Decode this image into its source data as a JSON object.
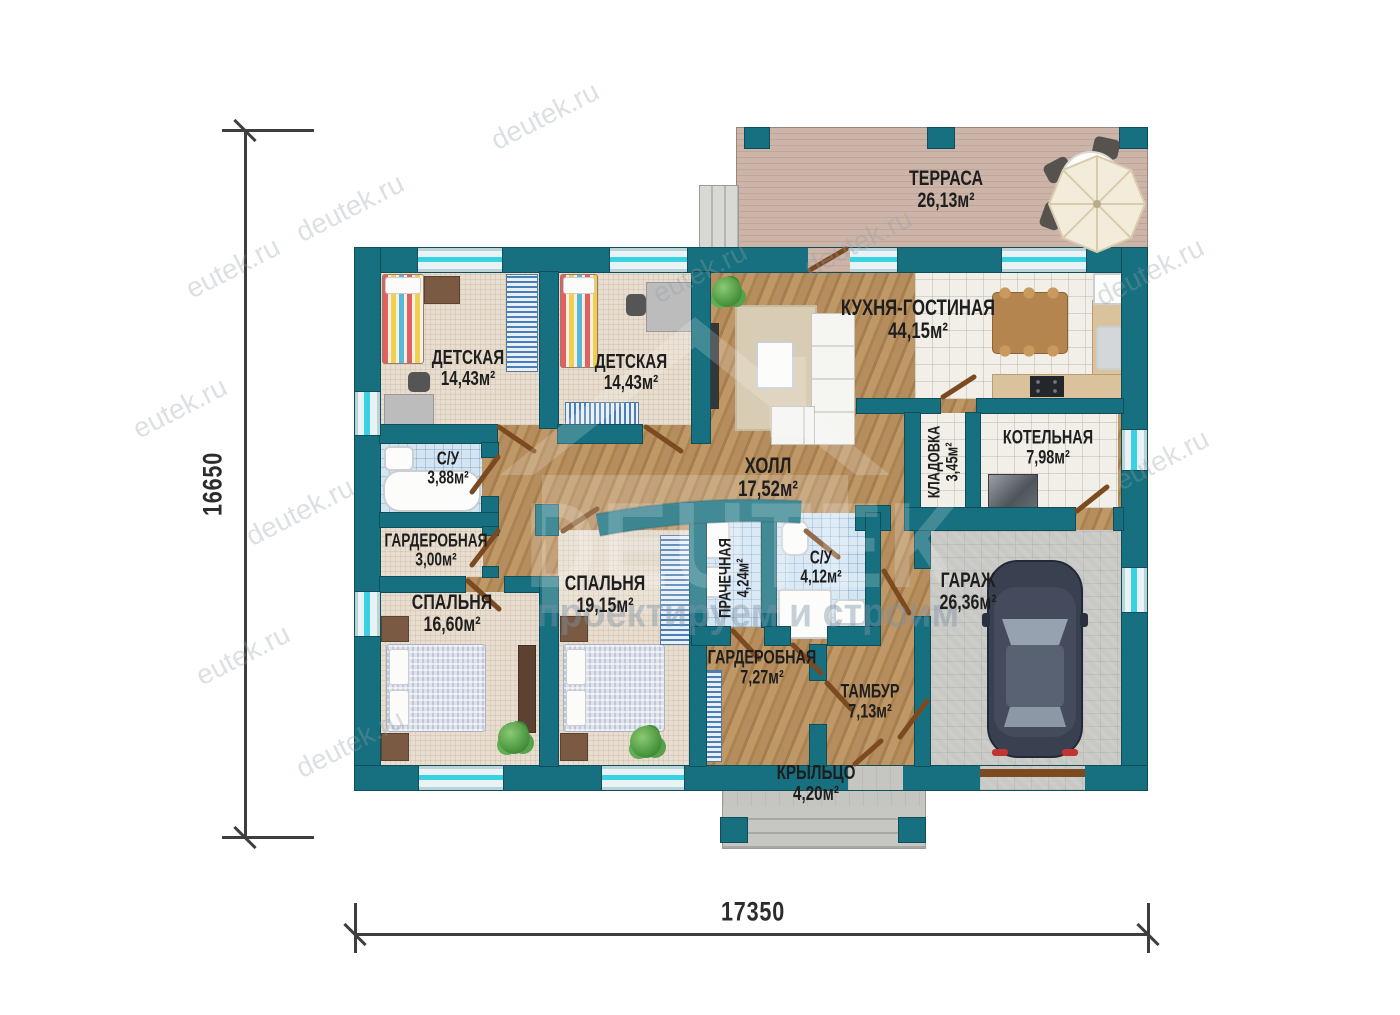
{
  "dimensions": {
    "horizontal": "17350",
    "vertical": "16650"
  },
  "rooms": {
    "terrace": {
      "name": "ТЕРРАСА",
      "area": "26,13м²"
    },
    "nursery1": {
      "name": "ДЕТСКАЯ",
      "area": "14,43м²"
    },
    "nursery2": {
      "name": "ДЕТСКАЯ",
      "area": "14,43м²"
    },
    "kitchen_living": {
      "name": "КУХНЯ-ГОСТИНАЯ",
      "area": "44,15м²"
    },
    "bathroom1": {
      "name": "С/У",
      "area": "3,88м²"
    },
    "hall": {
      "name": "ХОЛЛ",
      "area": "17,52м²"
    },
    "pantry": {
      "name": "КЛАДОВКА",
      "area": "3,45м²"
    },
    "boiler": {
      "name": "КОТЕЛЬНАЯ",
      "area": "7,98м²"
    },
    "wardrobe1": {
      "name": "ГАРДЕРОБНАЯ",
      "area": "3,00м²"
    },
    "bedroom1": {
      "name": "СПАЛЬНЯ",
      "area": "16,60м²"
    },
    "bedroom2": {
      "name": "СПАЛЬНЯ",
      "area": "19,15м²"
    },
    "laundry": {
      "name": "ПРАЧЕЧНАЯ",
      "area": "4,24м²"
    },
    "bathroom2": {
      "name": "С/У",
      "area": "4,12м²"
    },
    "wardrobe2": {
      "name": "ГАРДЕРОБНАЯ",
      "area": "7,27м²"
    },
    "vestibule": {
      "name": "ТАМБУР",
      "area": "7,13м²"
    },
    "garage": {
      "name": "ГАРАЖ",
      "area": "26,36м²"
    },
    "porch": {
      "name": "КРЫЛЬЦО",
      "area": "4,20м²"
    }
  },
  "watermarks": {
    "site_full": "deutek.ru",
    "site_partial": "eutek.ru",
    "brand": "DEUTEK",
    "slogan": "проектируем и строим"
  },
  "colors": {
    "wall": "#17707f",
    "window_accent": "#38d2e2",
    "door": "#7c4a21"
  }
}
